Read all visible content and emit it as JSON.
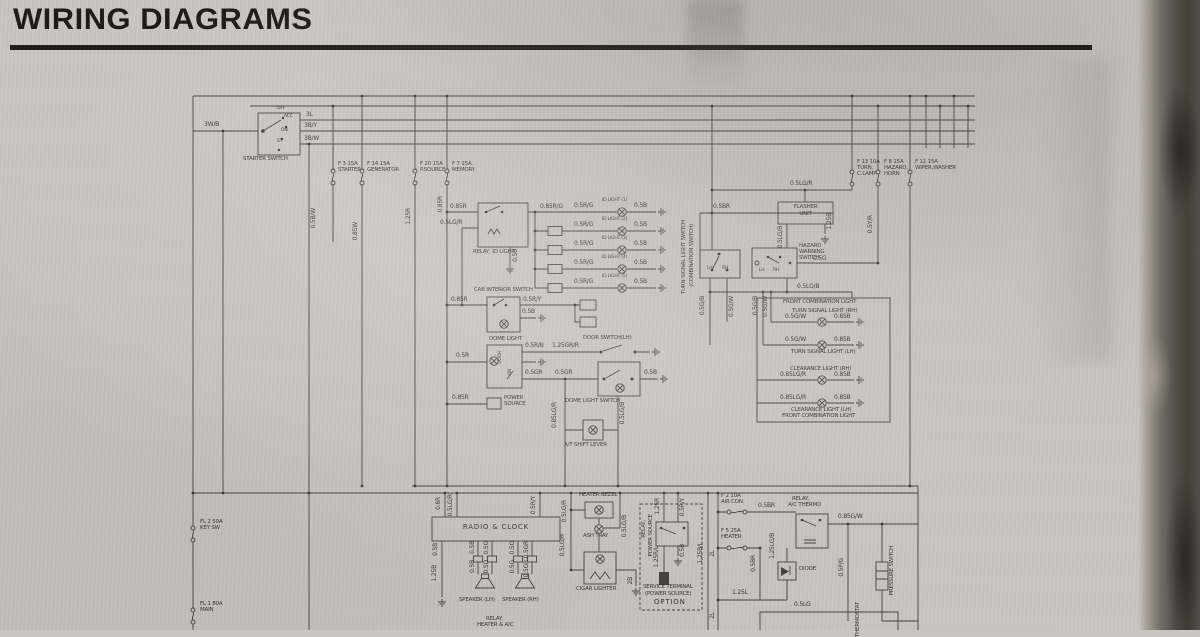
{
  "page": {
    "title": "WIRING DIAGRAMS"
  },
  "starter_switch": {
    "name": "STARTER SWITCH",
    "positions": [
      "OFF",
      "ACC",
      "ON",
      "ST"
    ],
    "feed_wire": "3W/B",
    "out_wires": [
      "3L",
      "3B/Y",
      "3B/W"
    ]
  },
  "fuses": {
    "starter": {
      "id": "F 3 15A",
      "name": "STARTER"
    },
    "generator": {
      "id": "F 14 15A",
      "name": "GENERATOR"
    },
    "p_source": {
      "id": "F 20 15A",
      "name": "P.SOURCE"
    },
    "memory": {
      "id": "F 7 15A",
      "name": "MEMORY"
    },
    "turn_clamp": {
      "id": "F 13 10A",
      "name": "TURN, C.LAMP"
    },
    "hazard_horn": {
      "id": "F 8 15A",
      "name": "HAZARD, HORN"
    },
    "wiper_washer": {
      "id": "F 11 15A",
      "name": "WIPER,WASHER"
    },
    "air_con": {
      "id": "F 2 10A",
      "name": "AIR CON"
    },
    "heater": {
      "id": "F 5 25A",
      "name": "HEATER"
    },
    "key_sw": {
      "id": "FL 2 50A",
      "name": "KEY SW"
    },
    "main": {
      "id": "FL 1 80A",
      "name": "MAIN"
    }
  },
  "trunk_wires": {
    "ign_bw": "0.5B/W",
    "gen_w": "0.85W",
    "psource": "1.25R",
    "memory": "0.85R"
  },
  "relay_id_light": {
    "name": "RELAY, ID LIGHT",
    "in_r": "0.85R",
    "in_lgr": "0.5LG/R",
    "gnd": "0.5B",
    "bus": "0.85R/G"
  },
  "id_lights": {
    "in_wire": "0.5R/G",
    "out_wire": "0.5B",
    "names": [
      "ID LIGHT (1)",
      "ID LIGHT (2)",
      "ID LIGHT (3)",
      "ID LIGHT (4)",
      "ID LIGHT (5)"
    ]
  },
  "cab_interior_switch": {
    "name": "CAB INTERIOR SWITCH",
    "in": "0.85R",
    "out": "0.5R/Y",
    "gnd": "0.5B"
  },
  "dome_light": {
    "name": "DOME LIGHT",
    "in": "0.5R",
    "pos_door": "DOOR",
    "pos_on": "ON",
    "out_rb": "0.5R/B",
    "out_grr": "1.25GR/R",
    "door_switch": "DOOR SWITCH(LH)",
    "out_gr": "0.5GR",
    "out_gr2": "0.5GR",
    "switch_gnd": "0.5B",
    "dome_switch": "DOME LIGHT SWITCH"
  },
  "power_source": {
    "name": "POWER SOURCE",
    "in": "0.85R"
  },
  "at_shift_lever": {
    "name": "A/T SHIFT LEVER",
    "left": "0.85LG/R",
    "right": "0.5LG/B"
  },
  "turn_signal_switch": {
    "name1": "TURN SIGNAL LIGHT SWITCH",
    "name2": "(COMBINATION SWITCH)",
    "feed": "0.5BR",
    "lh": "LH",
    "rh": "RH",
    "out_gb": "0.5G/B",
    "out_gw": "0.5G/W"
  },
  "flasher_unit": {
    "name1": "FLASHER",
    "name2": "UNIT",
    "feed": "0.5LG/R",
    "left": "0.5LG/B",
    "right": "1.25B"
  },
  "hazard_switch": {
    "name": "HAZARD WARNING SWITCH",
    "lh": "LH",
    "rh": "RH",
    "out": "0.5G",
    "feed": "0.5Y/R",
    "below": "0.5LG/B"
  },
  "front_combination_light": {
    "header": "FRONT COMBINATION LIGHT",
    "footer": "FRONT COMBINATION LIGHT",
    "feed_gb": "0.5G/B",
    "feed_gw": "0.5G/W",
    "rows": [
      {
        "name": "TURN SIGNAL LIGHT (RH)",
        "in": "0.5G/W",
        "out": "0.85B"
      },
      {
        "name": "TURN SIGNAL LIGHT (LH)",
        "in": "0.5G/W",
        "out": "0.85B"
      },
      {
        "name": "CLEARANCE LIGHT (RH)",
        "in": "0.85LG/R",
        "out": "0.85B"
      },
      {
        "name": "CLEARANCE LIGHT (LH)",
        "in": "0.85LG/R",
        "out": "0.85B"
      }
    ]
  },
  "radio_clock": {
    "name": "RADIO & CLOCK",
    "in1": "0.6R",
    "in2": "0.5LG/R",
    "in3": "0.5R/Y",
    "gnd1": "0.5B",
    "gnd2": "1.25B",
    "spk_lh": {
      "name": "SPEAKER (LH)",
      "w1": "0.5B",
      "w2": "0.5O"
    },
    "spk_rh": {
      "name": "SPEAKER (RH)",
      "w1": "0.5G",
      "w2": "0.5GR"
    }
  },
  "heater_bezel": {
    "name": "HEATER BEZEL",
    "ash": "ASH TRAY",
    "cigar": "CIGAR LIGHTER",
    "feed1": "0.5LG/R",
    "feed2": "0.5LG/R",
    "right": "0.5LG/B",
    "gnd": "2B"
  },
  "service_terminal": {
    "relay1": "RELAY,",
    "relay2": "POWER SOURCE",
    "in1": "1.25R",
    "in2": "0.5R/Y",
    "out": "1.25R/L",
    "gnd": "0.5B",
    "cap1": "SERVICE TERMINAL",
    "cap2": "(POWER SOURCE)",
    "cap3": "OPTION",
    "side": "1.25B/L"
  },
  "heater_ac": {
    "w2l_a": "2L",
    "w2l_b": "2L",
    "feed_br": "0.5BR",
    "br_v": "0.5BR",
    "relay1": "RELAY,",
    "relay2": "A/C THERMO",
    "out_gw": "0.85G/W",
    "lgb": "1.25LG/B",
    "diode": "DIODE",
    "l_wire": "1.25L",
    "pg": "0.5P/G",
    "lg": "0.5LG",
    "pressure": "PRESSURE SWITCH",
    "thermostat": "THERMOSTAT",
    "relay_heater1": "RELAY,",
    "relay_heater2": "HEATER & A/C"
  }
}
